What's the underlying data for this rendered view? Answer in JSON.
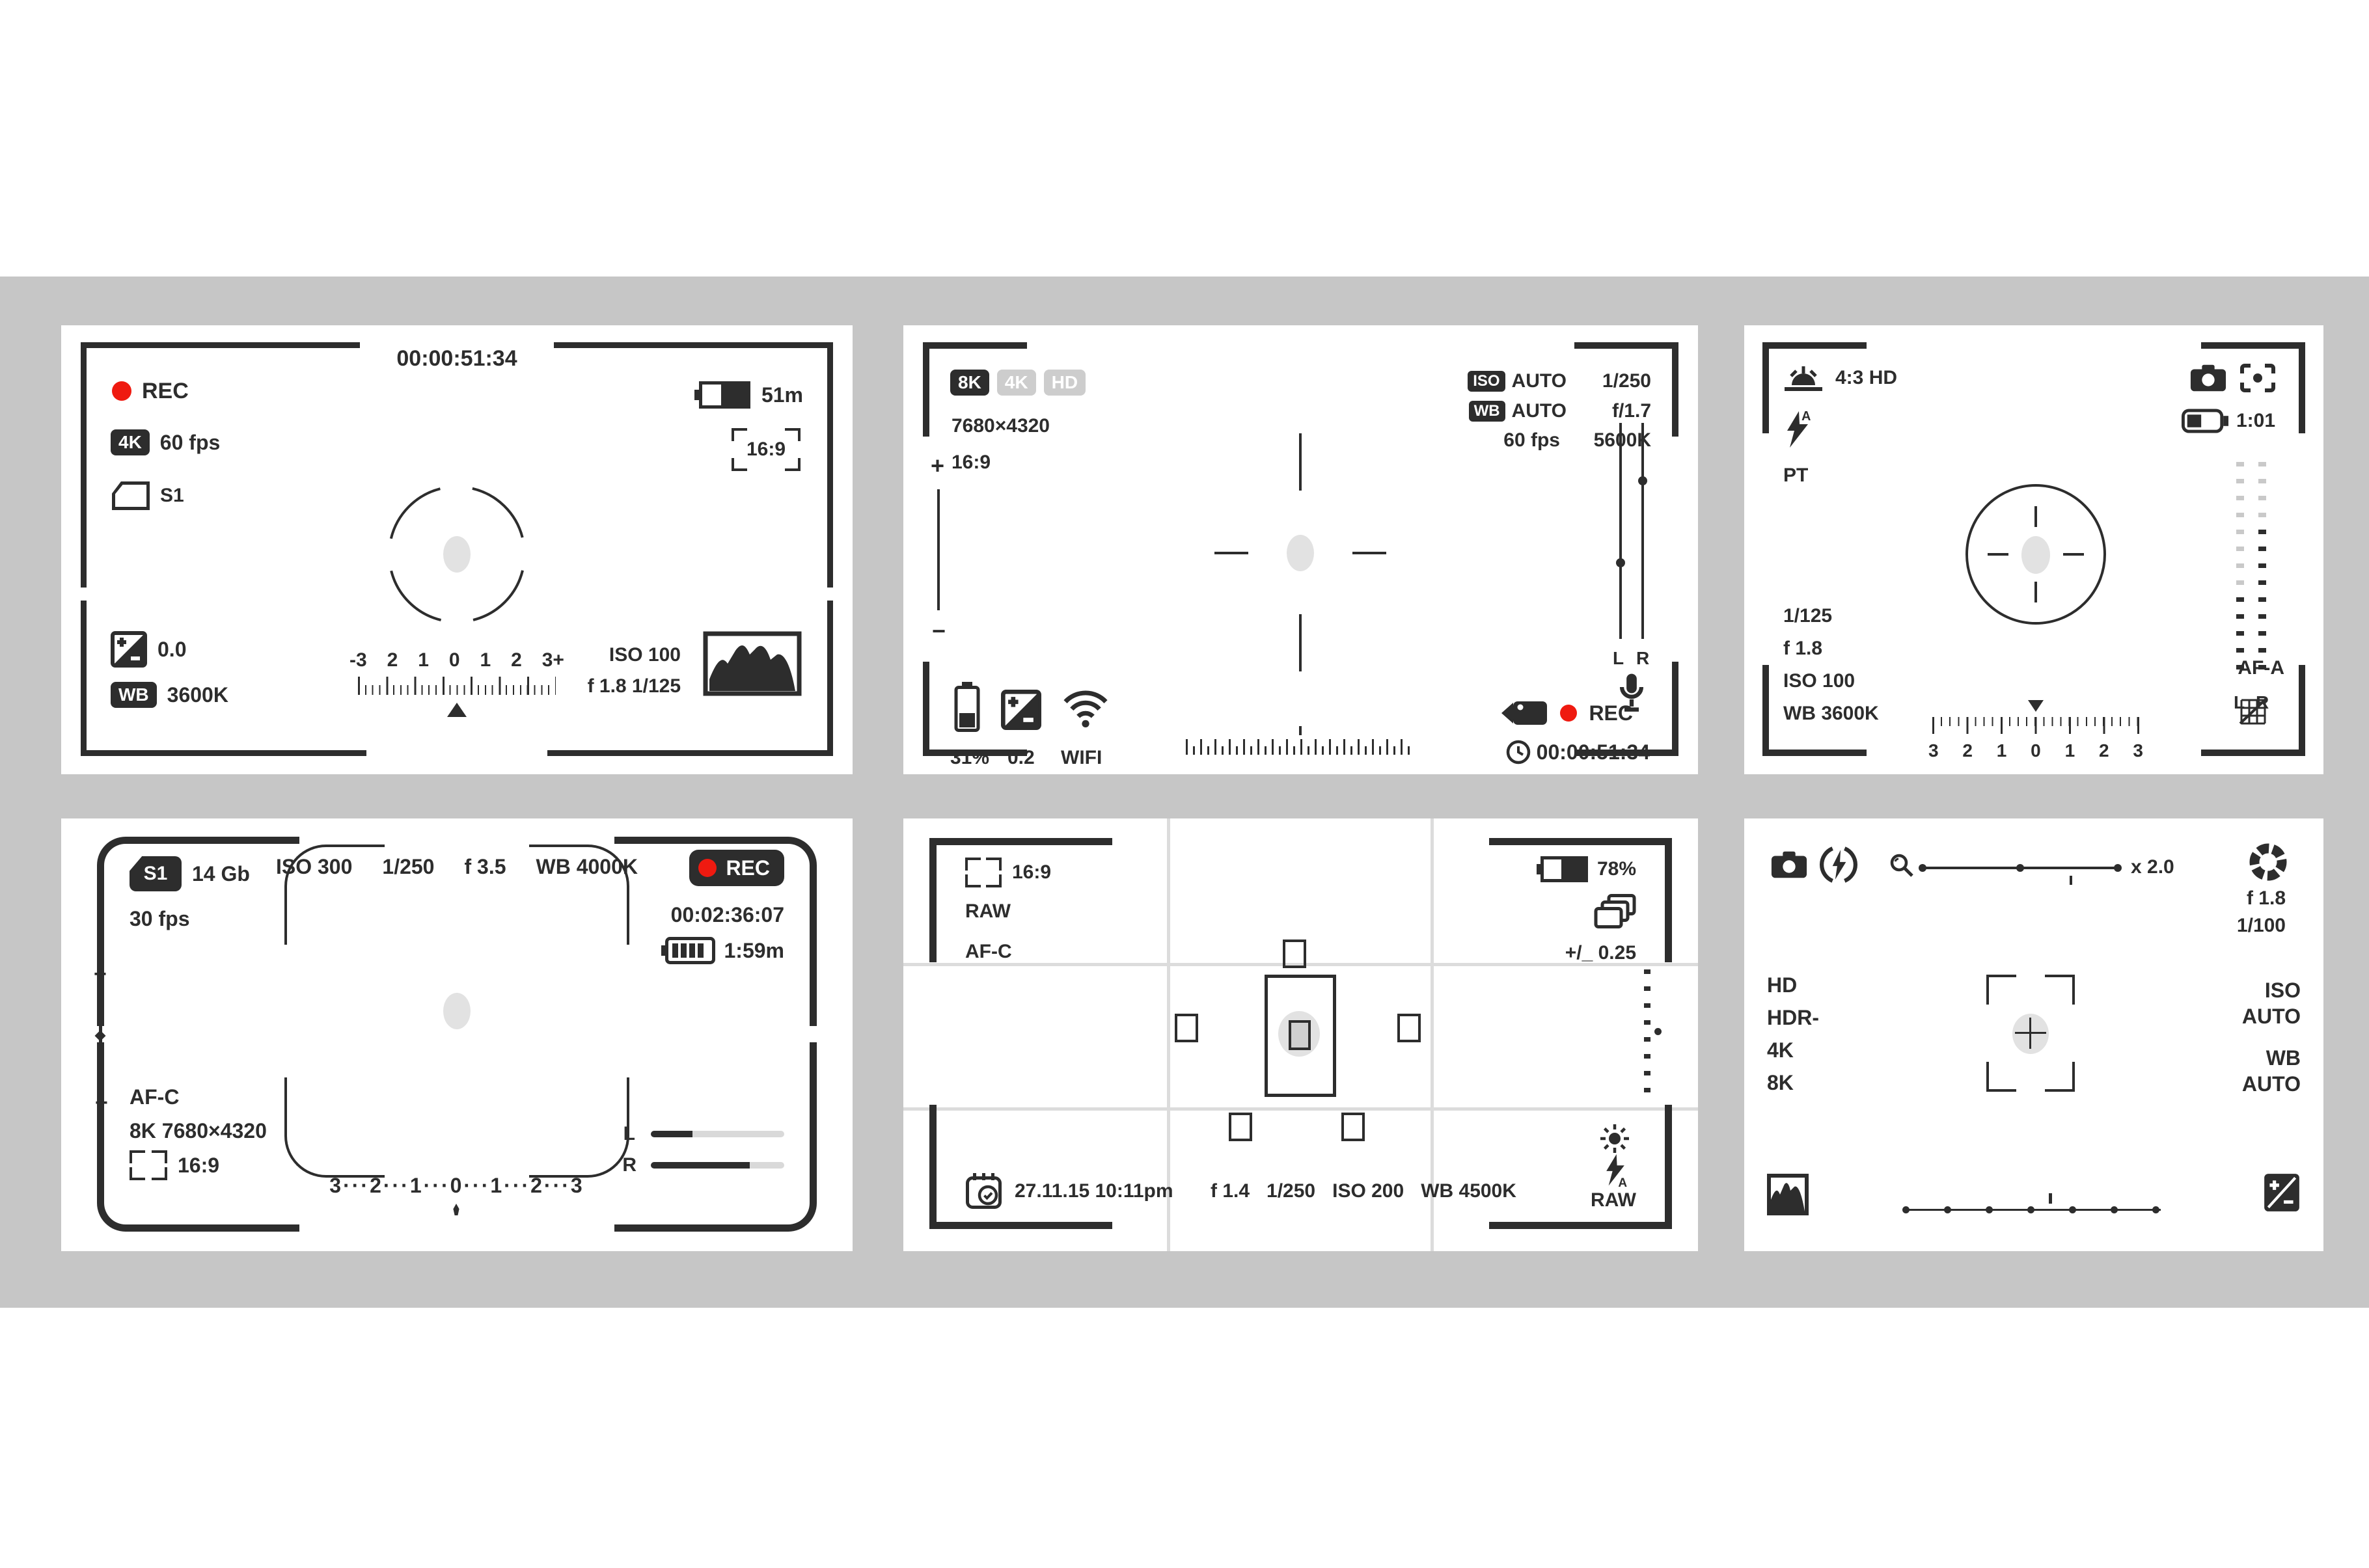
{
  "colors": {
    "ink": "#2d2d2d",
    "red": "#ef1a10",
    "band_gray": "#c6c6c6",
    "badge_gray": "#cdcdcd",
    "bar_gray": "#d9d9d9"
  },
  "panel1": {
    "timecode": "00:00:51:34",
    "rec": "REC",
    "res_badge": "4K",
    "fps": "60 fps",
    "card": "S1",
    "battery_time": "51m",
    "aspect": "16:9",
    "ev": "0.0",
    "wb_badge": "WB",
    "wb_value": "3600K",
    "iso": "ISO 100",
    "exposure": "f 1.8  1/125",
    "scale": [
      "-3",
      "2",
      "1",
      "0",
      "1",
      "2",
      "3+"
    ]
  },
  "panel2": {
    "badges": [
      "8K",
      "4K",
      "HD"
    ],
    "resolution": "7680×4320",
    "aspect": "16:9",
    "rows": [
      {
        "badge": "ISO",
        "label": "AUTO",
        "value": "1/250"
      },
      {
        "badge": "WB",
        "label": "AUTO",
        "value": "f/1.7"
      },
      {
        "label": "60 fps",
        "value": "5600K"
      }
    ],
    "plus": "+",
    "minus": "−",
    "battery": "31%",
    "ev": "0.2",
    "wifi": "WIFI",
    "meter_l": "L",
    "meter_r": "R",
    "rec": "REC",
    "timecode": "00:00:51:34"
  },
  "panel3": {
    "mode": "4:3 HD",
    "pt": "PT",
    "battery_time": "1:01",
    "shutter": "1/125",
    "aperture": "f 1.8",
    "iso": "ISO 100",
    "wb": "WB 3600K",
    "af": "AF-A",
    "meter_l": "L",
    "meter_r": "R",
    "scale": [
      "3",
      "2",
      "1",
      "0",
      "1",
      "2",
      "3"
    ]
  },
  "panel4": {
    "card": "S1",
    "storage": "14 Gb",
    "fps": "30 fps",
    "iso": "ISO 300",
    "shutter": "1/250",
    "aperture": "f 3.5",
    "wb": "WB 4000K",
    "rec": "REC",
    "timecode": "00:02:36:07",
    "battery_time": "1:59m",
    "af": "AF-C",
    "resolution": "8K 7680×4320",
    "aspect": "16:9",
    "plus": "+",
    "minus": "−",
    "scale": "3···2···1···0···1···2···3",
    "meter_l": "L",
    "meter_r": "R"
  },
  "panel5": {
    "aspect": "16:9",
    "format": "RAW",
    "af": "AF-C",
    "battery": "78%",
    "bracketing": "+/_ 0.25",
    "datetime": "27.11.15 10:11pm",
    "aperture": "f 1.4",
    "shutter": "1/250",
    "iso": "ISO 200",
    "wb": "WB 4500K",
    "format2": "RAW"
  },
  "panel6": {
    "zoom": "x 2.0",
    "aperture": "f 1.8",
    "shutter": "1/100",
    "modes": [
      "HD",
      "HDR-",
      "4K",
      "8K"
    ],
    "iso_label": "ISO",
    "iso_value": "AUTO",
    "wb_label": "WB",
    "wb_value": "AUTO"
  }
}
